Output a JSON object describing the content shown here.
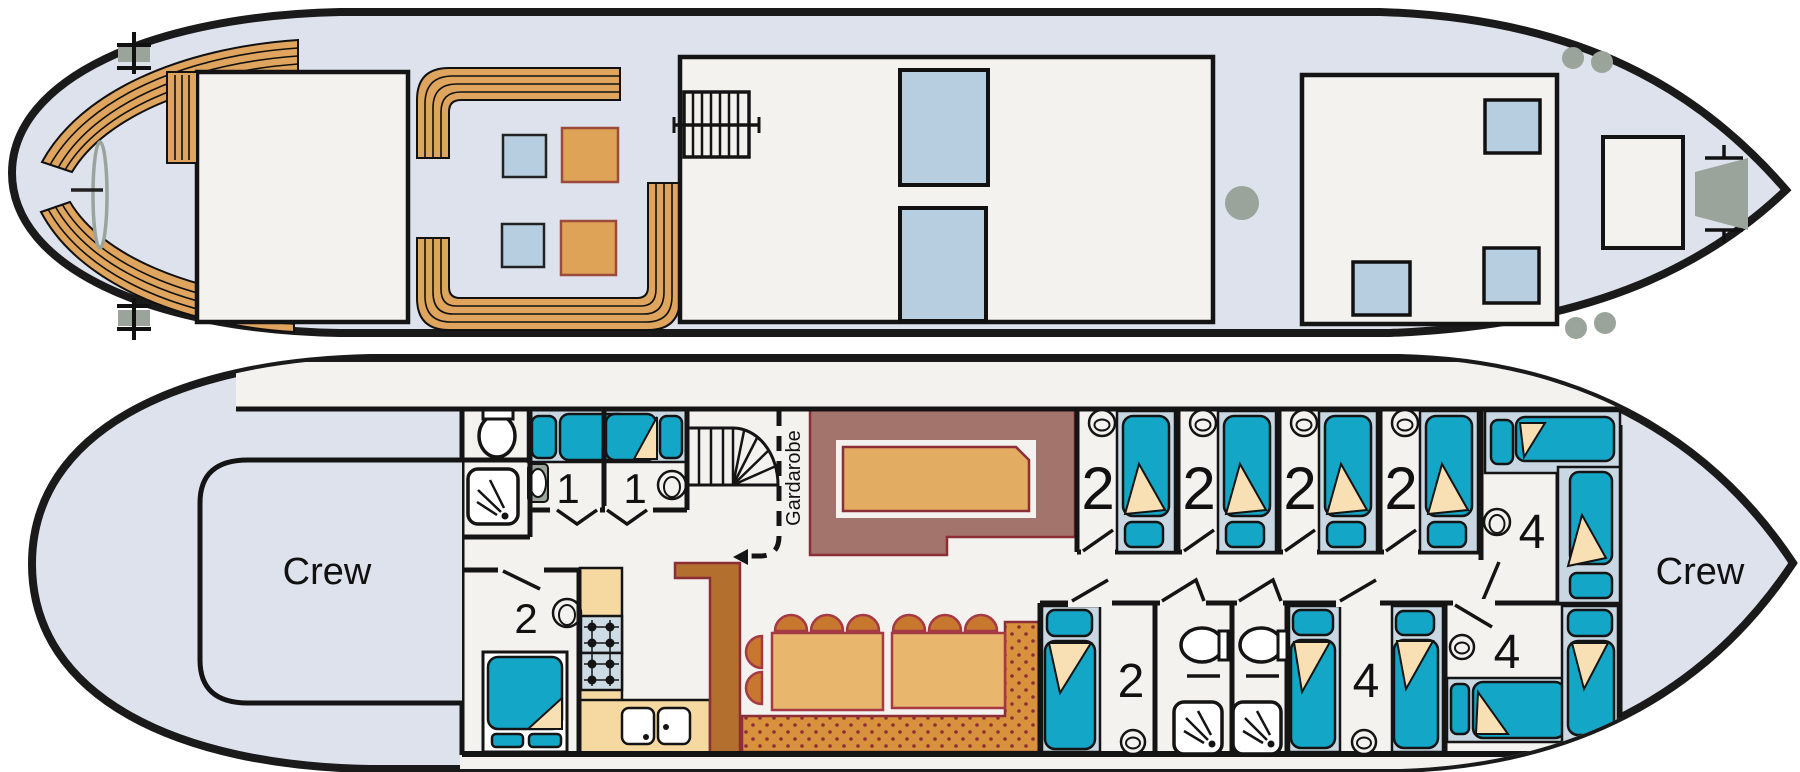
{
  "diagram": {
    "type": "boat-deck-plan",
    "subject": "hotel barge deck plans, upper sun deck and lower accommodation deck"
  },
  "labels": {
    "crew_aft": "Crew",
    "crew_fore": "Crew",
    "wardrobe": "Gardarobe"
  },
  "cabins": [
    {
      "id": "cabin-single-1",
      "label": "1"
    },
    {
      "id": "cabin-single-2",
      "label": "1"
    },
    {
      "id": "cabin-double",
      "label": "2"
    },
    {
      "id": "cabin-twin-1",
      "label": "2"
    },
    {
      "id": "cabin-twin-2",
      "label": "2"
    },
    {
      "id": "cabin-twin-3",
      "label": "2"
    },
    {
      "id": "cabin-twin-4",
      "label": "2"
    },
    {
      "id": "cabin-twin-5",
      "label": "2"
    },
    {
      "id": "cabin-quad-upper-fore",
      "label": "4"
    },
    {
      "id": "cabin-quad-mid",
      "label": "4"
    },
    {
      "id": "cabin-quad-fore",
      "label": "4"
    }
  ],
  "icons": [
    "toilet-icon",
    "shower-icon",
    "washbasin-icon",
    "bed-icon",
    "stairs-icon",
    "spiral-stairs-icon",
    "stove-icon",
    "sink-icon",
    "propeller-icon",
    "bollard-icon",
    "funnel-icon",
    "anchor-winch-icon",
    "chair-icon",
    "dining-table",
    "bar-counter",
    "banquette-seat",
    "sun-bench",
    "deck-table",
    "skylight"
  ],
  "colors": {
    "hull_fill": "#dde2ed",
    "hull_line": "#1a1a1a",
    "structure_fill": "#f4f2ef",
    "wall": "#141414",
    "wood_bench": "#dfa55e",
    "table_blue": "#b7cee0",
    "table_orange": "#dfa358",
    "bed_teal": "#14a6c6",
    "bed_bg": "#c8d7e2",
    "pillow_cream": "#f9e0b4",
    "bar_mauve": "#a2746c",
    "counter_tan": "#e2ad62",
    "dining_tan": "#e9b66d",
    "chair_orange": "#c8772f",
    "banquette_orange": "#d8923e",
    "wood_dark": "#b36f2e",
    "accent_maroon": "#8c2e36",
    "hardware_gray": "#9aa49b",
    "kitchen_tan": "#f6d9a0",
    "stove_blue": "#ccdbe4"
  }
}
